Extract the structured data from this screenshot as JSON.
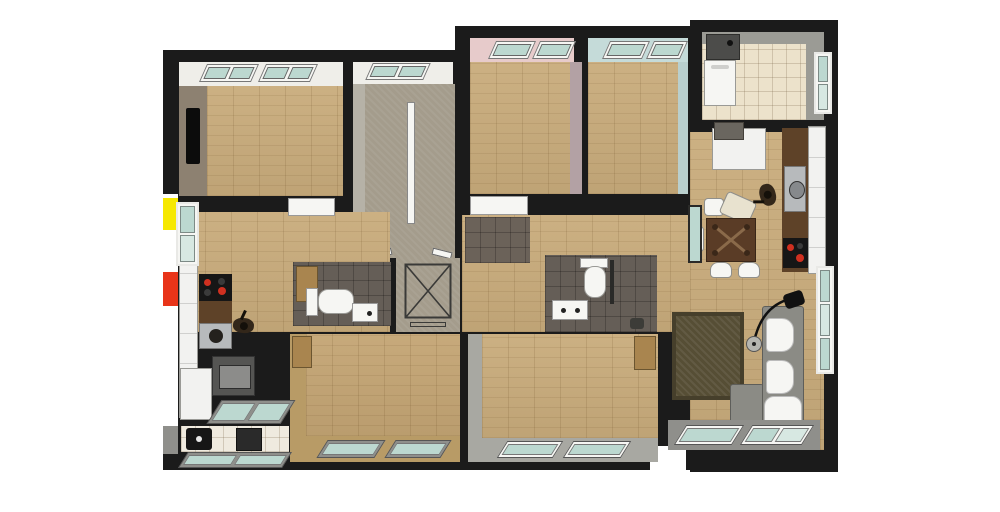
{
  "scene": {
    "kind": "3d-floor-plan-render",
    "view": "top-down axonometric cutaway of an attic apartment floor",
    "apartments": [
      {
        "id": "left-apartment",
        "rooms": [
          "bedroom-top-left",
          "hallway-kitchen",
          "bathroom-1",
          "bedroom-bottom-left",
          "utility-room"
        ]
      },
      {
        "id": "right-apartment",
        "rooms": [
          "bedroom-pink",
          "bedroom-blue",
          "utility-top-right",
          "open-kitchen-dining-living",
          "bathroom-2",
          "bedroom-bottom-middle"
        ]
      }
    ],
    "core": [
      "stairwell",
      "elevator-shaft"
    ],
    "furniture": [
      "kitchen-counter",
      "cooktop",
      "sink",
      "oven",
      "fridge",
      "dining-table",
      "chairs",
      "sofa",
      "chaise",
      "arc-floor-lamp",
      "rug",
      "toilet",
      "washbasin",
      "wall-cabinet",
      "washer",
      "boiler",
      "person-figure",
      "skylight-windows",
      "roof-windows"
    ]
  },
  "colors": {
    "canvas": "#ffffff",
    "wall": "#1b1b1b",
    "wood": "#c9ac7c",
    "wood_warm": "#c4a574",
    "stair": "#a49c8c",
    "stair_side": "#b6b2a7",
    "tile_dark": "#655e57",
    "tile_entry": "#6b6259",
    "tile_cream": "#ece2cb",
    "tile_white": "#efeadf",
    "ceiling": "#efeee9",
    "wall_pink": "#e7cbcb",
    "wall_pink_side": "#b3a1a4",
    "wall_blue": "#c5dbd9",
    "wall_blue_side": "#b9cfcd",
    "wall_taupe": "#8d8171",
    "wall_tan": "#b89b66",
    "wall_gray": "#a8a8a2",
    "wall_gray2": "#9b9b95",
    "frame_gray": "#8f8f8b",
    "glass": "#bcd8d0",
    "glass_light": "#d7e8e2",
    "white": "#f6f6f3",
    "recess_black": "#0c0c0c",
    "counter_brown": "#5e4228",
    "appliance_black": "#161616",
    "appliance_gray": "#555553",
    "appliance_dark": "#2a2a2a",
    "burner_red": "#d03020",
    "steel": "#b7babc",
    "cabinet_white": "#f2f2f0",
    "wood_furniture": "#a9854f",
    "table_brown": "#5a3c26",
    "rug": "#564e35",
    "sofa_gray": "#8b8b85",
    "person": "#33271a",
    "lamp_black": "#111111",
    "accent_yellow": "#f6e800",
    "accent_red": "#e83419",
    "boiler_gray": "#4c4c4a"
  }
}
